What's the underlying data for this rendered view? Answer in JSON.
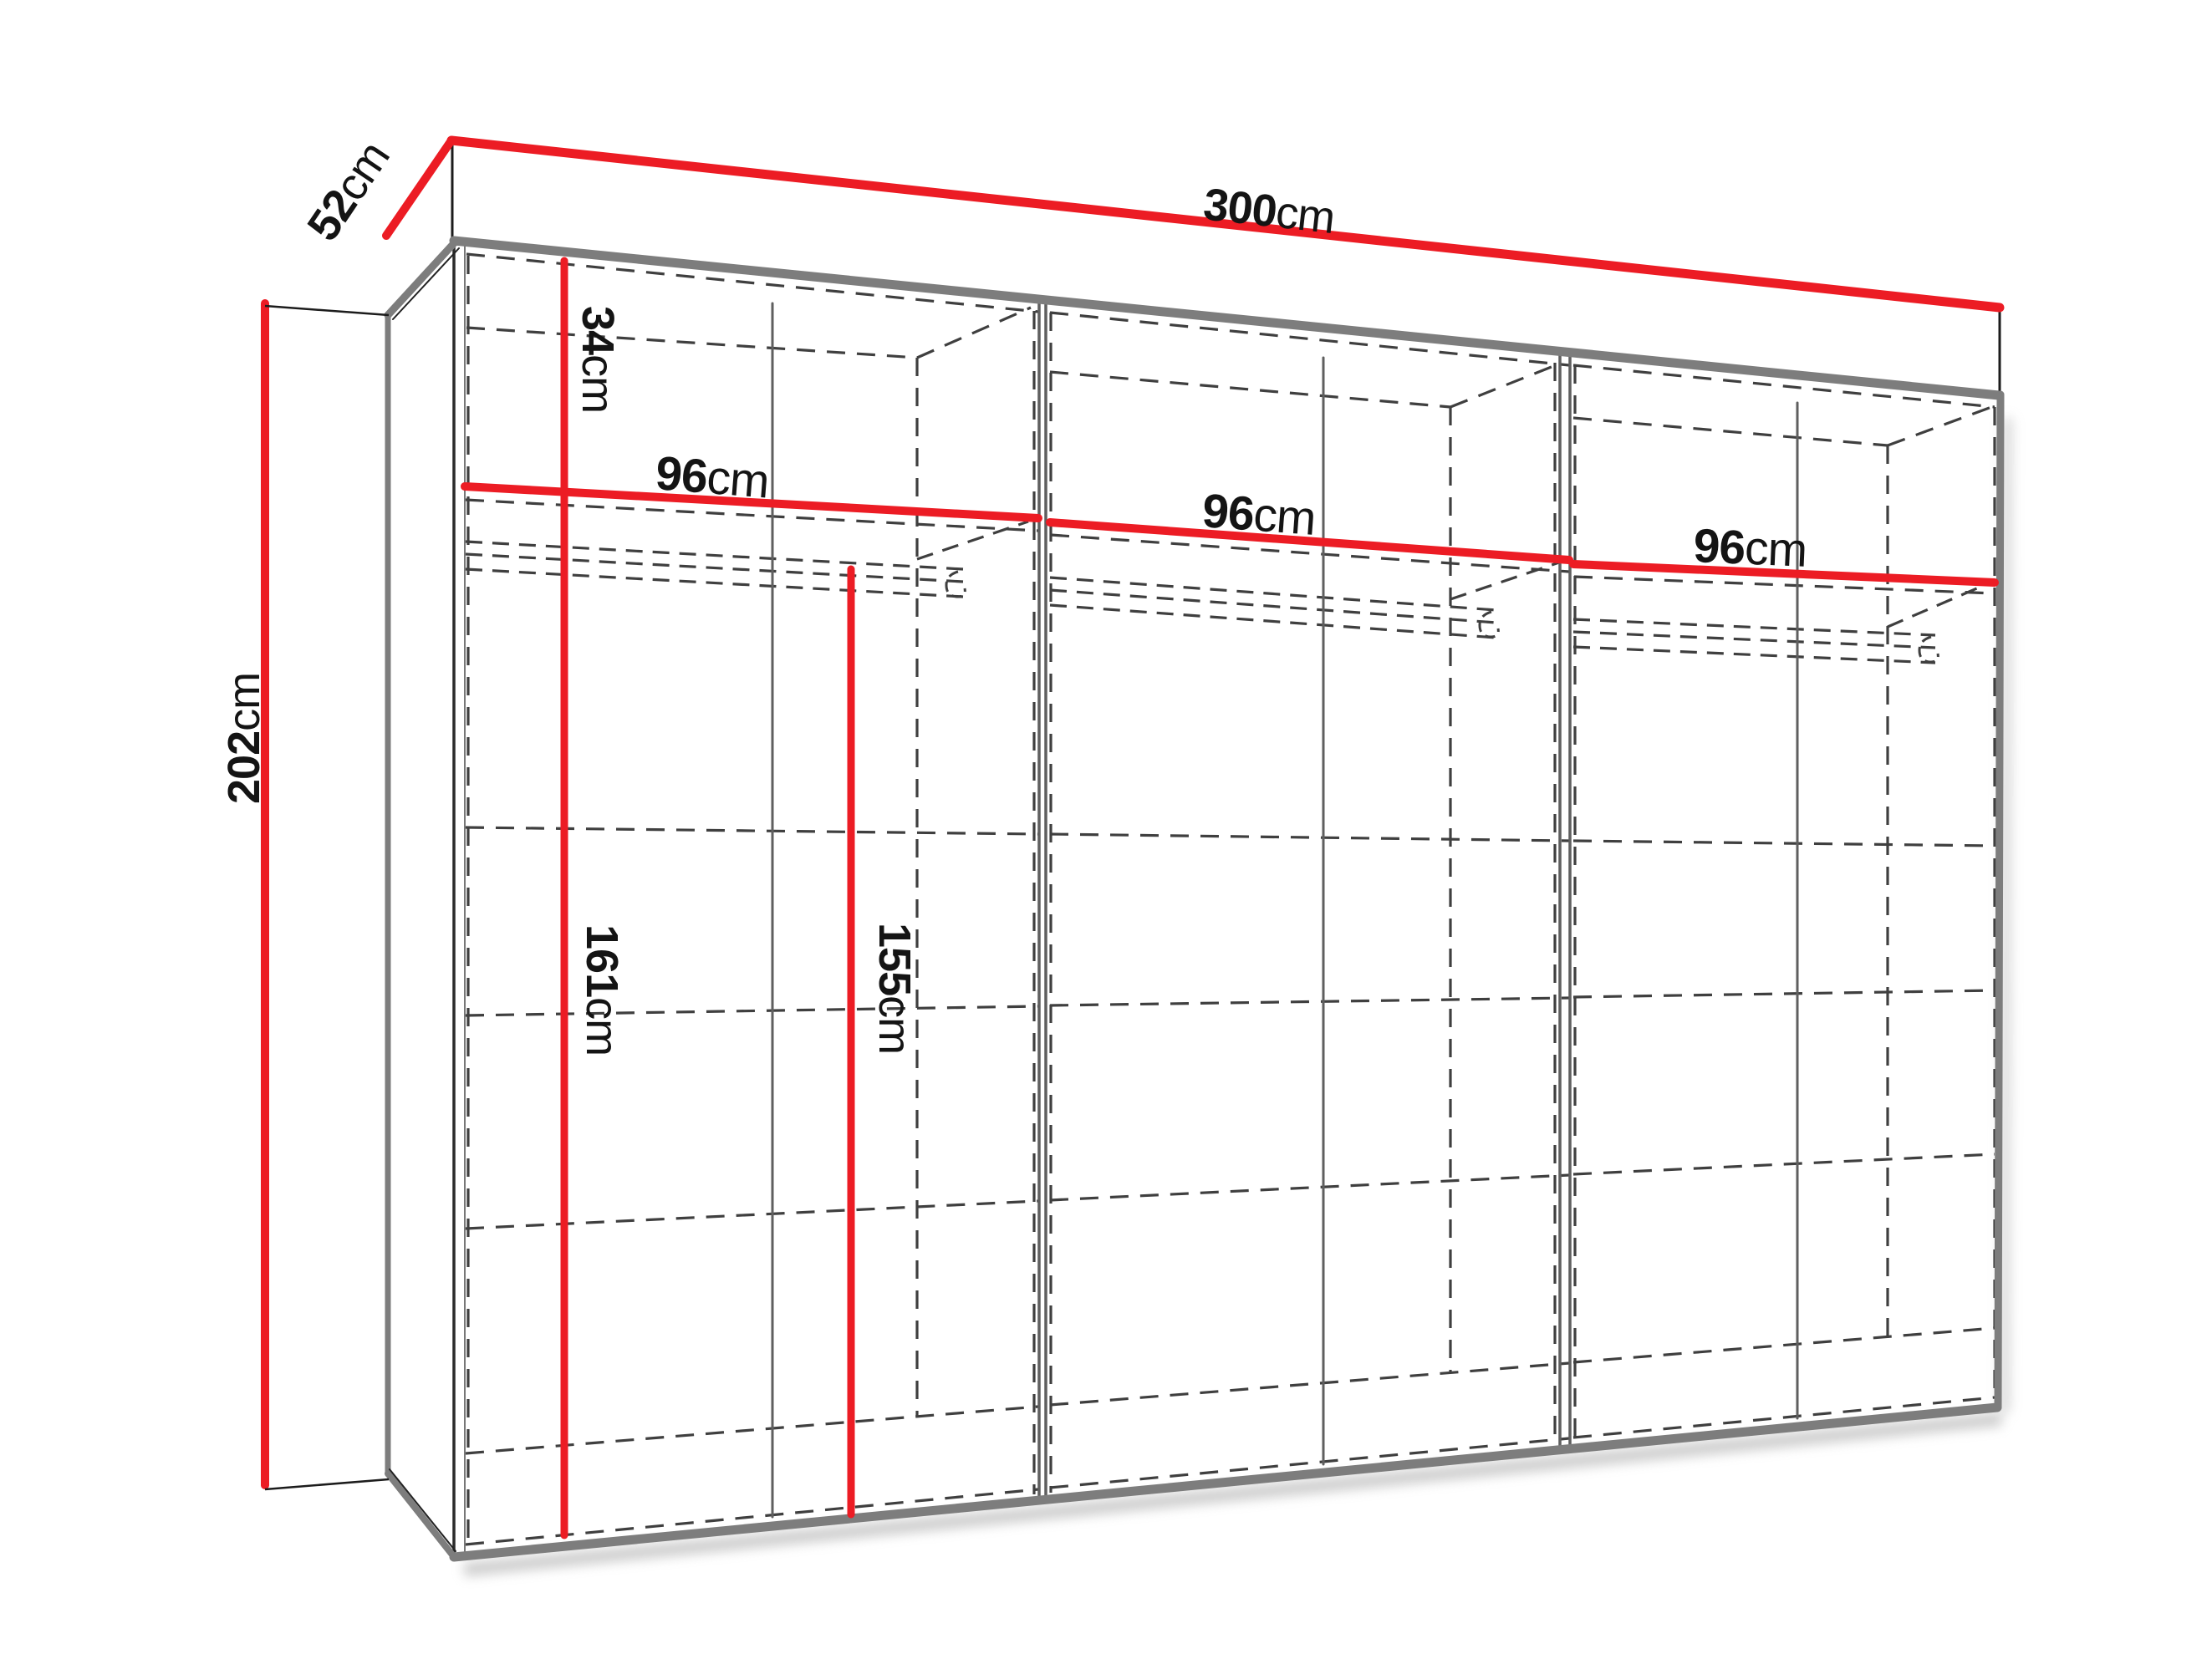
{
  "diagram": {
    "type": "wardrobe-dimension-drawing",
    "unit": "cm",
    "dimensions": {
      "total_width": {
        "value": "300",
        "unit": "cm"
      },
      "depth": {
        "value": "52",
        "unit": "cm"
      },
      "total_height": {
        "value": "202",
        "unit": "cm"
      },
      "top_shelf_height": {
        "value": "34",
        "unit": "cm"
      },
      "section1_width": {
        "value": "96",
        "unit": "cm"
      },
      "section2_width": {
        "value": "96",
        "unit": "cm"
      },
      "section3_width": {
        "value": "96",
        "unit": "cm"
      },
      "lower_inner_height": {
        "value": "161",
        "unit": "cm"
      },
      "hanging_height": {
        "value": "155",
        "unit": "cm"
      }
    },
    "colors": {
      "dimension_line": "#ec1c24",
      "edge_gray": "#7d7d7d",
      "edge_dark": "#2b2b2b",
      "inner_gray": "#5f5f5f",
      "dashed": "#3f3f3f",
      "text": "#141414",
      "background": "#ffffff"
    },
    "icons": {
      "hanger_hook": "hanger-hook-icon"
    }
  }
}
